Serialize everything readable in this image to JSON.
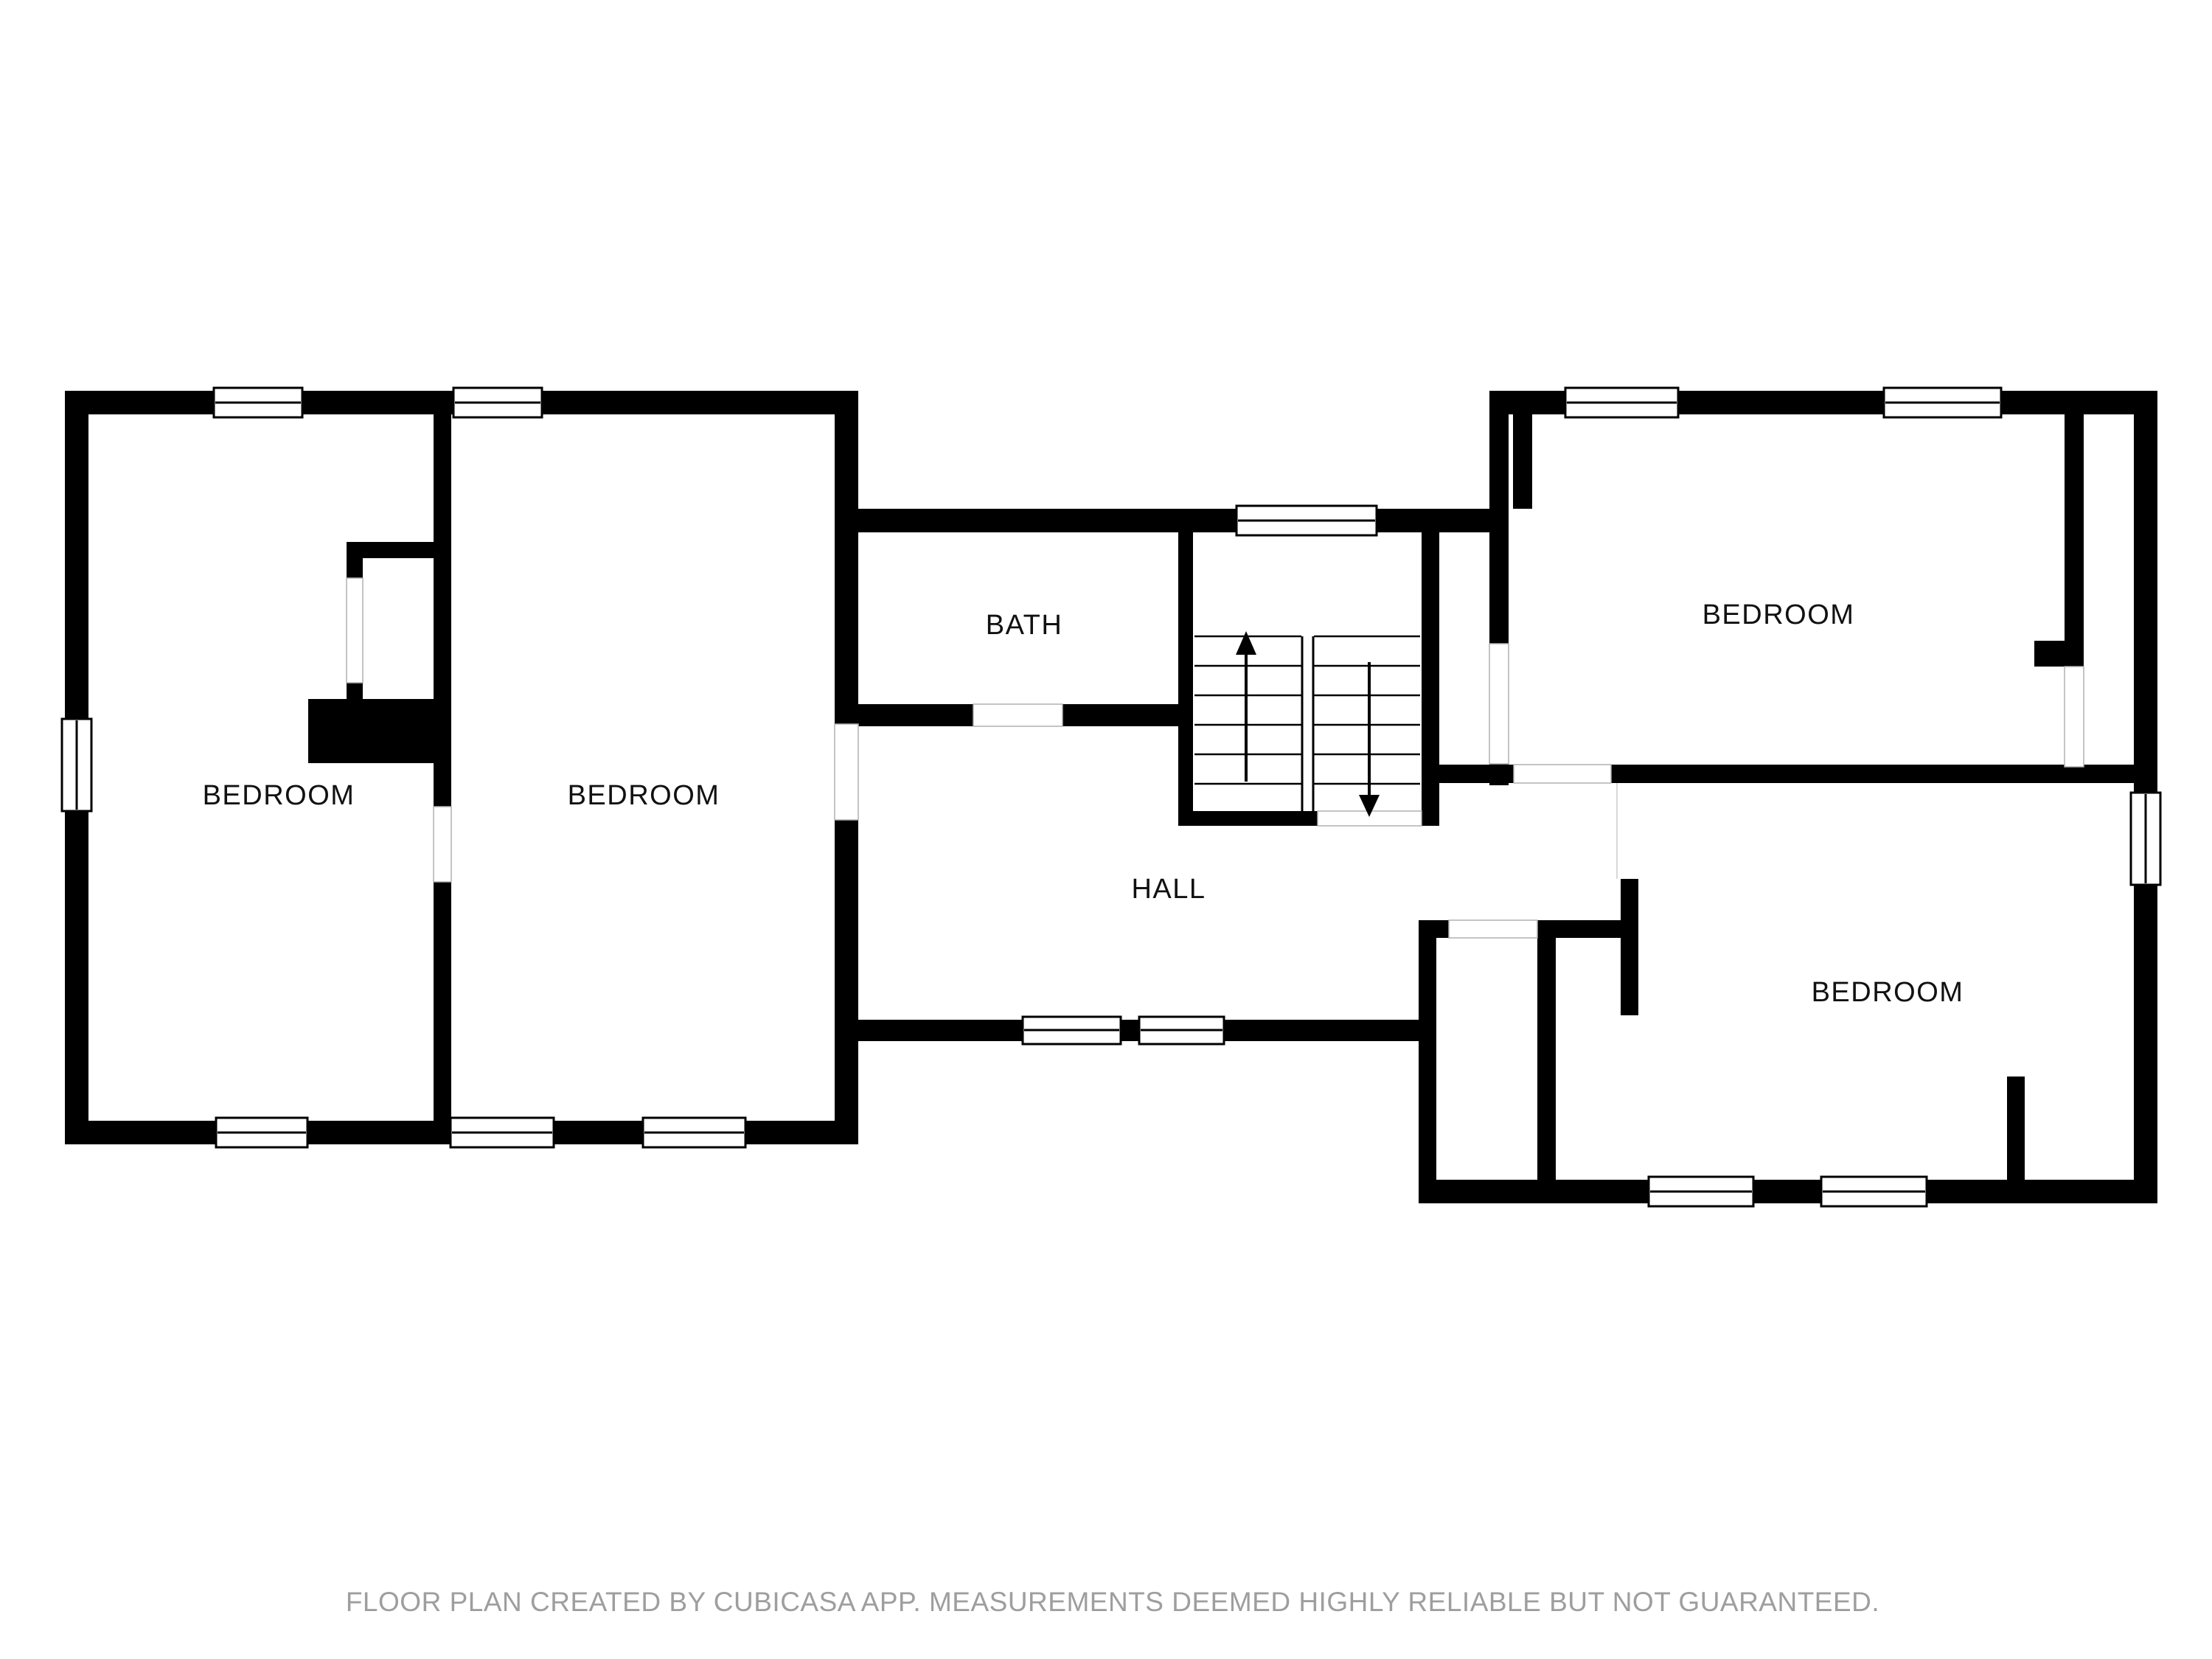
{
  "document": {
    "type": "floor-plan",
    "creator_note": "FLOOR PLAN CREATED BY CUBICASA APP. MEASUREMENTS DEEMED HIGHLY RELIABLE BUT NOT GUARANTEED."
  },
  "colors": {
    "wall": "#000000",
    "background": "#ffffff",
    "label": "#111111",
    "footer": "#9e9e9e",
    "door_opening_line": "#b0b0b0"
  },
  "rooms": [
    {
      "id": "bedroom-left",
      "label": "BEDROOM"
    },
    {
      "id": "bedroom-center",
      "label": "BEDROOM"
    },
    {
      "id": "bath",
      "label": "BATH"
    },
    {
      "id": "hall",
      "label": "HALL"
    },
    {
      "id": "bedroom-top-right",
      "label": "BEDROOM"
    },
    {
      "id": "bedroom-bottom-right",
      "label": "BEDROOM"
    }
  ],
  "stairs": {
    "up_arrow": "up",
    "down_arrow": "down",
    "treads_per_flight": 7
  },
  "counts": {
    "windows": 14,
    "door_openings": 9
  }
}
